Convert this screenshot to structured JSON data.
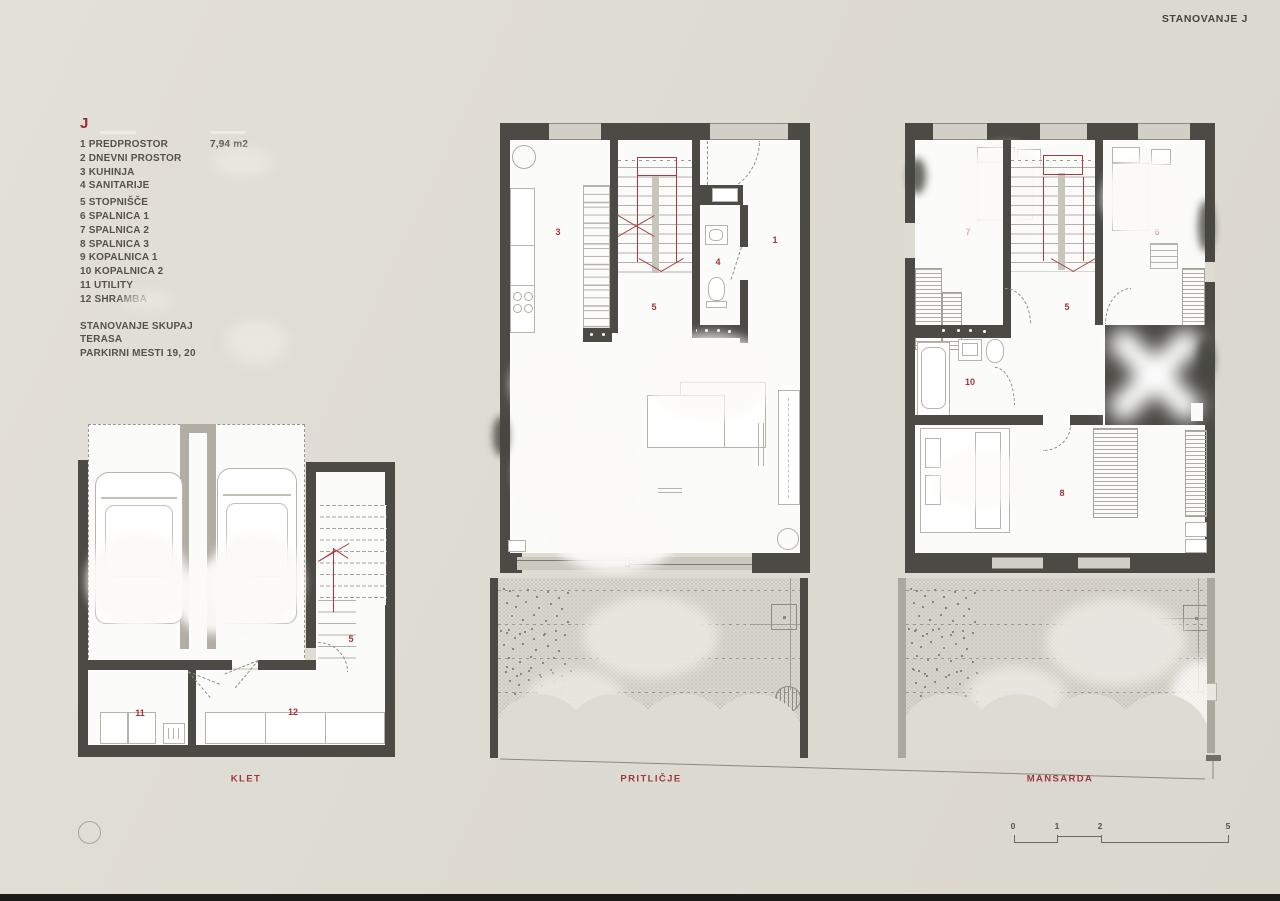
{
  "header": {
    "title": "STANOVANJE J"
  },
  "legend": {
    "unit": "J",
    "items": [
      {
        "label": "1 PREDPROSTOR",
        "value": "7,94 m2"
      },
      {
        "label": "2 DNEVNI PROSTOR",
        "value": ""
      },
      {
        "label": "3 KUHINJA",
        "value": ""
      },
      {
        "label": "4 SANITARIJE",
        "value": ""
      },
      {
        "label": "5 STOPNIŠČE",
        "value": ""
      },
      {
        "label": "6 SPALNICA 1",
        "value": ""
      },
      {
        "label": "7 SPALNICA 2",
        "value": ""
      },
      {
        "label": "8 SPALNICA 3",
        "value": ""
      },
      {
        "label": "9 KOPALNICA 1",
        "value": ""
      },
      {
        "label": "10 KOPALNICA 2",
        "value": ""
      },
      {
        "label": "11 UTILITY",
        "value": ""
      },
      {
        "label": "12 SHRAMBA",
        "value": ""
      }
    ],
    "summary": [
      {
        "label": "STANOVANJE SKUPAJ",
        "value": ""
      },
      {
        "label": "TERASA",
        "value": ""
      },
      {
        "label": "PARKIRNI MESTI 19, 20",
        "value": ""
      }
    ]
  },
  "plans": {
    "klet": {
      "label": "KLET",
      "room_numbers": {
        "stairs": "5",
        "utility": "11",
        "storage": "12"
      }
    },
    "pritlicje": {
      "label": "PRITLIČJE",
      "room_numbers": {
        "kitchen": "3",
        "stairs": "5",
        "hall": "1",
        "wc": "4"
      }
    },
    "mansarda": {
      "label": "MANSARDA",
      "room_numbers": {
        "stairs": "5",
        "bedroom1": "6",
        "bedroom2": "7",
        "bathroom2": "10",
        "bedroom3": "8"
      }
    }
  },
  "scale_bar": {
    "ticks": [
      "0",
      "1",
      "2",
      "5"
    ]
  },
  "colors": {
    "wall": "#4b4a45",
    "accent_red": "#a2343a",
    "background": "#dedbd3"
  }
}
